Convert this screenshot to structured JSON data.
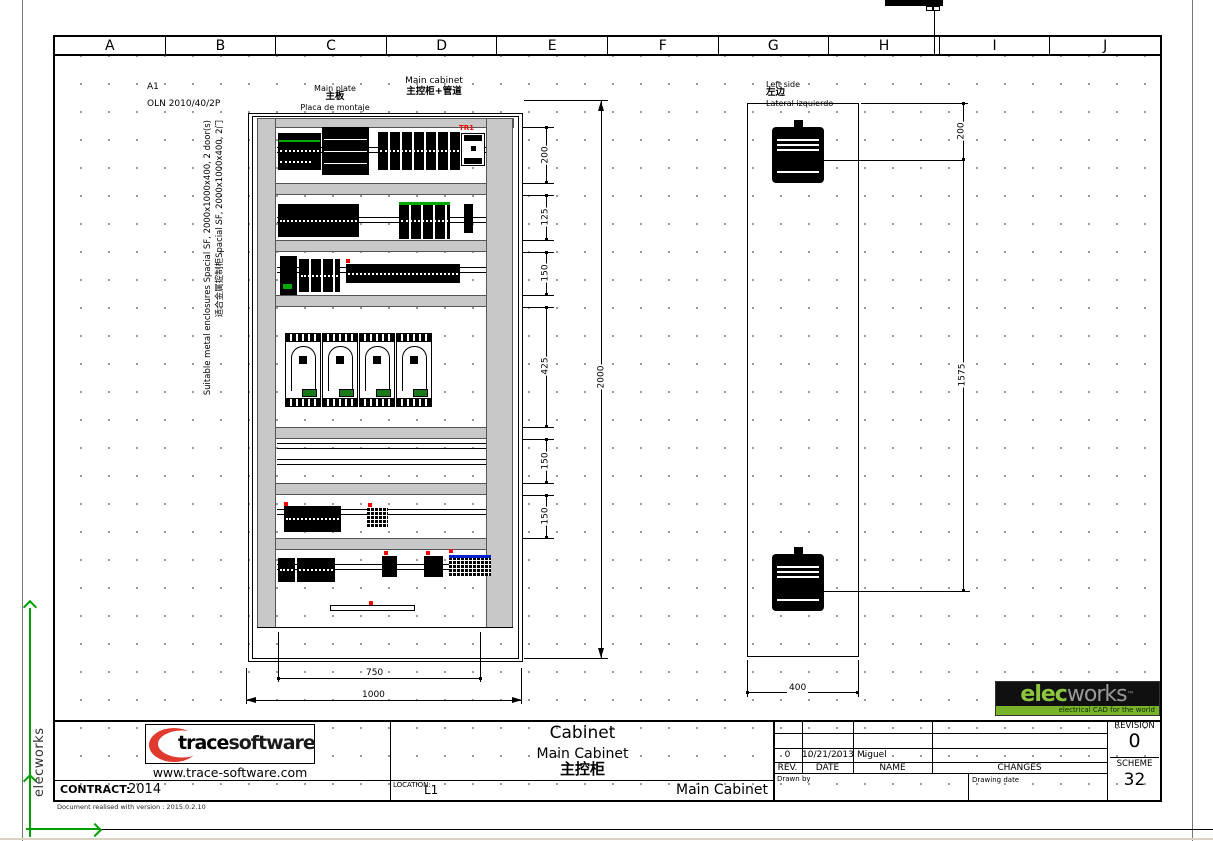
{
  "sheet": {
    "columns": [
      "A",
      "B",
      "C",
      "D",
      "E",
      "F",
      "G",
      "H",
      "I",
      "J"
    ],
    "margin_text": "elecworks",
    "version_note": "Document realised with version : 2015.0.2.10"
  },
  "annotations": {
    "format": "A1",
    "reference": "OLN 2010/40/2P",
    "enclosure_en": "Suitable metal enclosures Spacial SF, 2000x1000x400, 2 door(s)",
    "enclosure_zh": "适合金属控制柜Spacial SF, 2000x1000x400, 2门"
  },
  "front_view": {
    "label_plate_en": "Main plate",
    "label_plate_zh": "主板",
    "label_plate_es": "Placa de montaje",
    "label_cabinet_en": "Main cabinet",
    "label_cabinet_zh": "主控柜+管道",
    "component_tag": "TR1",
    "dims": {
      "chain": [
        "200",
        "125",
        "150",
        "425",
        "150",
        "150"
      ],
      "overall": "2000",
      "plate_width": "750",
      "cabinet_width": "1000"
    }
  },
  "side_view": {
    "label_en": "Left side",
    "label_zh": "左边",
    "label_es": "Lateral izquierdo",
    "dims": {
      "top": "200",
      "span": "1575",
      "depth": "400"
    }
  },
  "title_block": {
    "logo_bold": "trace",
    "logo_light": "software",
    "website": "www.trace-software.com",
    "contract_label": "CONTRACT:",
    "contract_value": "2014",
    "location_label": "LOCATION:",
    "location_value": "L1",
    "title_en": "Cabinet",
    "subtitle_en": "Main Cabinet",
    "subtitle_zh": "主控柜",
    "drawing_name": "Main Cabinet",
    "rev_headers": [
      "REV.",
      "DATE",
      "NAME",
      "CHANGES"
    ],
    "rev_row": {
      "rev": "0",
      "date": "10/21/2013",
      "name": "Miguel",
      "changes": ""
    },
    "drawn_by_label": "Drawn by",
    "drawing_date_label": "Drawing date",
    "revision_label": "REVISION",
    "revision_value": "0",
    "scheme_label": "SCHEME",
    "scheme_value": "32"
  },
  "elecworks": {
    "part1": "elec",
    "part2": "works",
    "tm": "™",
    "tagline": "electrical CAD for the world"
  }
}
